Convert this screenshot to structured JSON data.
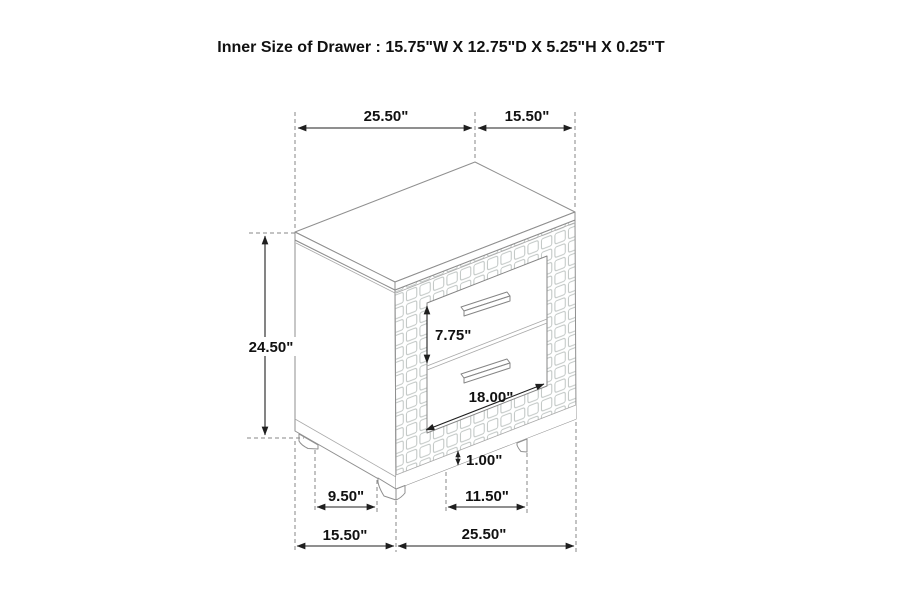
{
  "title": "Inner Size of Drawer : 15.75\"W X 12.75\"D X 5.25\"H X 0.25\"T",
  "dimensions": {
    "top_width": "25.50\"",
    "top_depth": "15.50\"",
    "overall_height": "24.50\"",
    "drawer_front_height": "7.75\"",
    "drawer_front_width": "18.00\"",
    "base_rail_height": "1.00\"",
    "side_leg_span": "9.50\"",
    "front_leg_span": "11.50\"",
    "bottom_depth": "15.50\"",
    "bottom_width": "25.50\""
  },
  "colors": {
    "background": "#ffffff",
    "cabinet_line": "#8f8f8f",
    "texture_line": "#bdc3c1",
    "dimension_line": "#1f1f1f",
    "text": "#111111"
  }
}
